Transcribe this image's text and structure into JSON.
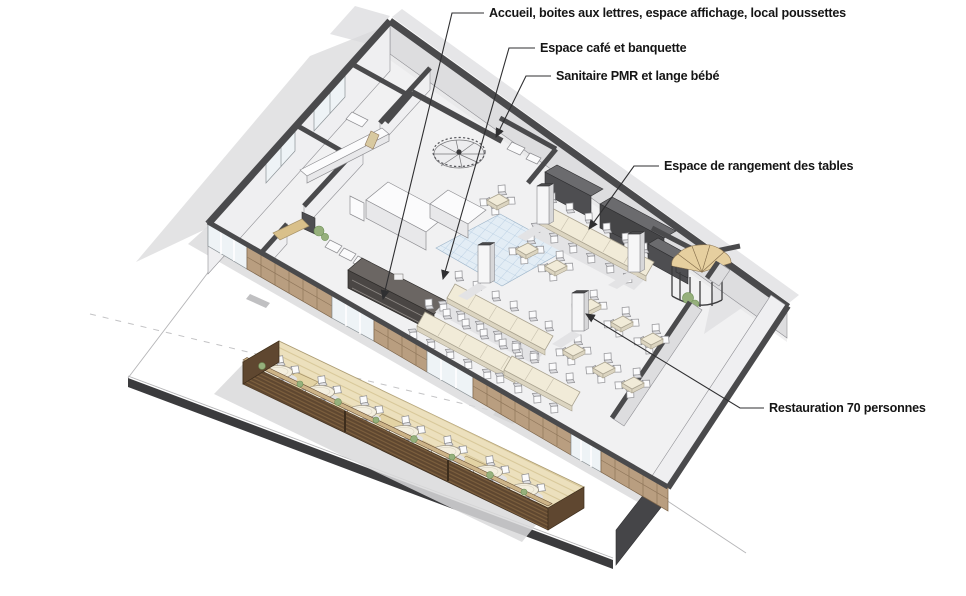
{
  "diagram": {
    "type": "axonometric-cutaway-floor-plan",
    "annotations": [
      {
        "id": "accueil",
        "label": "Accueil, boites aux lettres, espace affichage, local poussettes"
      },
      {
        "id": "cafe",
        "label": "Espace café et banquette"
      },
      {
        "id": "sanitaire",
        "label": "Sanitaire PMR et lange bébé"
      },
      {
        "id": "rangement",
        "label": "Espace de rangement des tables"
      },
      {
        "id": "restauration",
        "label": "Restauration 70 personnes"
      }
    ],
    "colors": {
      "wall_cut": "#4a4a4c",
      "wall_face": "#efefF1",
      "cabinet": "#4e4e51",
      "wood": "#b99e80",
      "deck": "#ece0bd",
      "planter": "#5f4730",
      "table_top": "#f1ebd8",
      "tile": "#e3edf5",
      "plant": "#96b07c",
      "shadow": "#d9d9db",
      "leader": "#2f2f31",
      "text": "#151515"
    }
  }
}
